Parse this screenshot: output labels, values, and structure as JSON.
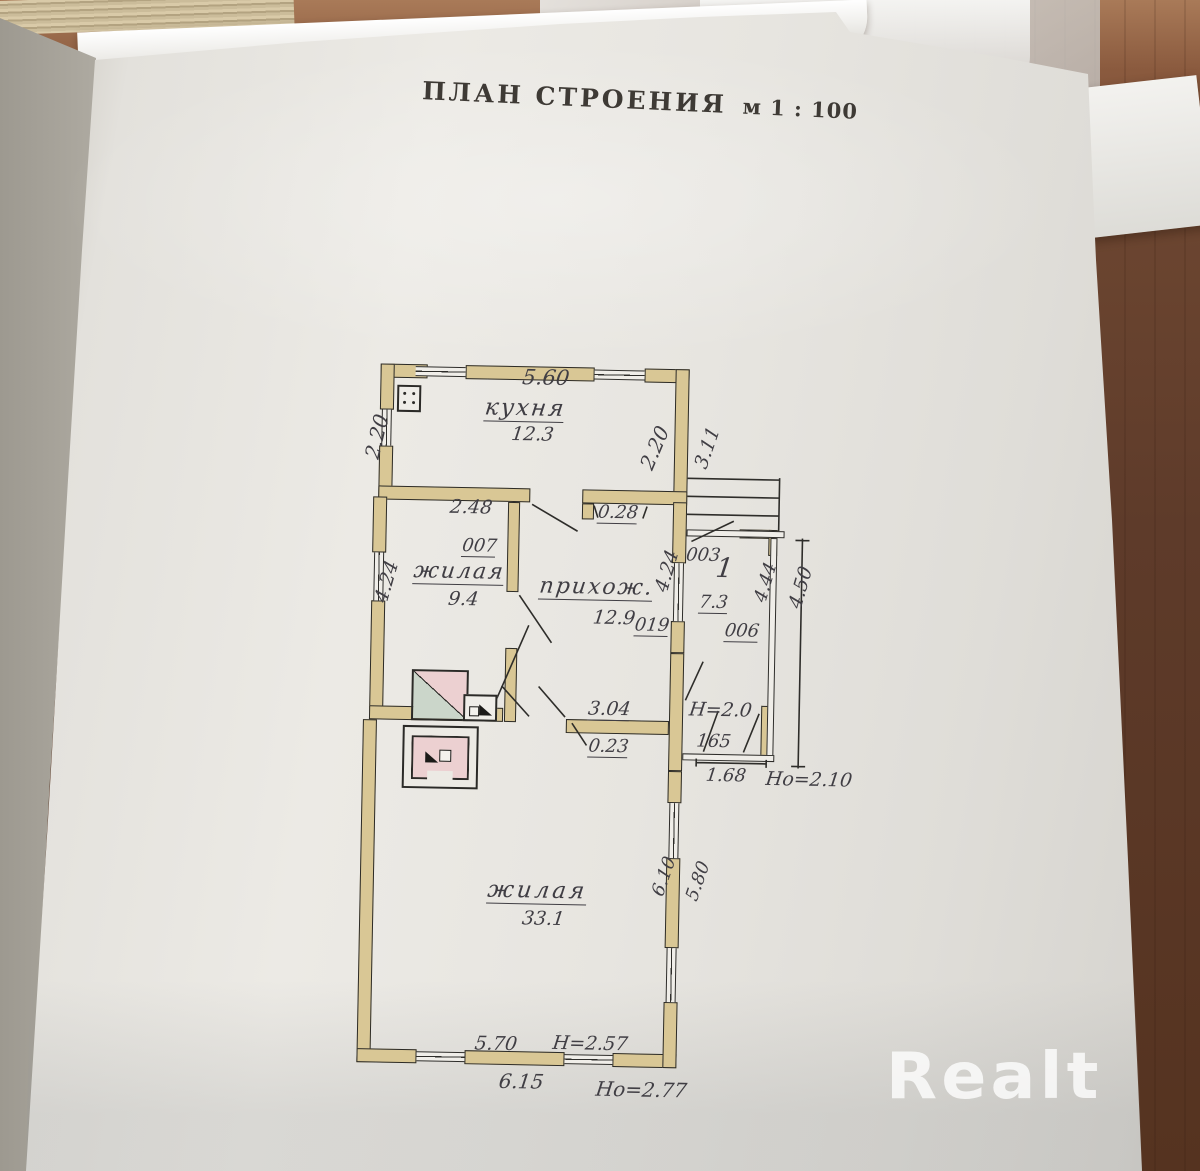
{
  "photo": {
    "watermark_text": "Realt"
  },
  "title": {
    "main": "ПЛАН СТРОЕНИЯ",
    "scale": "м 1 : 100"
  },
  "rooms": {
    "kitchen": {
      "name": "кухня",
      "area": "12.3"
    },
    "living_small": {
      "name": "жилая",
      "area": "9.4"
    },
    "hallway": {
      "name": "прихож.",
      "area": "12.9"
    },
    "living_large": {
      "name": "жилая",
      "area": "33.1"
    },
    "veranda": {
      "number": "1",
      "area": "7.3"
    }
  },
  "dims": {
    "kitchen_top": "5.60",
    "kitchen_left": "2.20",
    "kitchen_right": "2.20",
    "kitchen_right_ext": "3.11",
    "small_top": "2.48",
    "pier_007": "007",
    "door_028": "0.28",
    "small_left": "4.24",
    "hall_right": "4.24",
    "pier_003": "003",
    "veranda_in": "4.44",
    "veranda_out": "4.50",
    "pier_006": "006",
    "door_019": "019",
    "opening_304": "3.04",
    "pier_023": "0.23",
    "veranda_h": "Н=2.0",
    "veranda_165": "165",
    "veranda_168": "1.68",
    "veranda_ho": "Но=2.10",
    "large_right_in": "6.10",
    "large_right_out": "5.80",
    "large_bottom_in": "5.70",
    "large_h": "Н=2.57",
    "large_bottom_out": "6.15",
    "large_ho": "Но=2.77"
  }
}
